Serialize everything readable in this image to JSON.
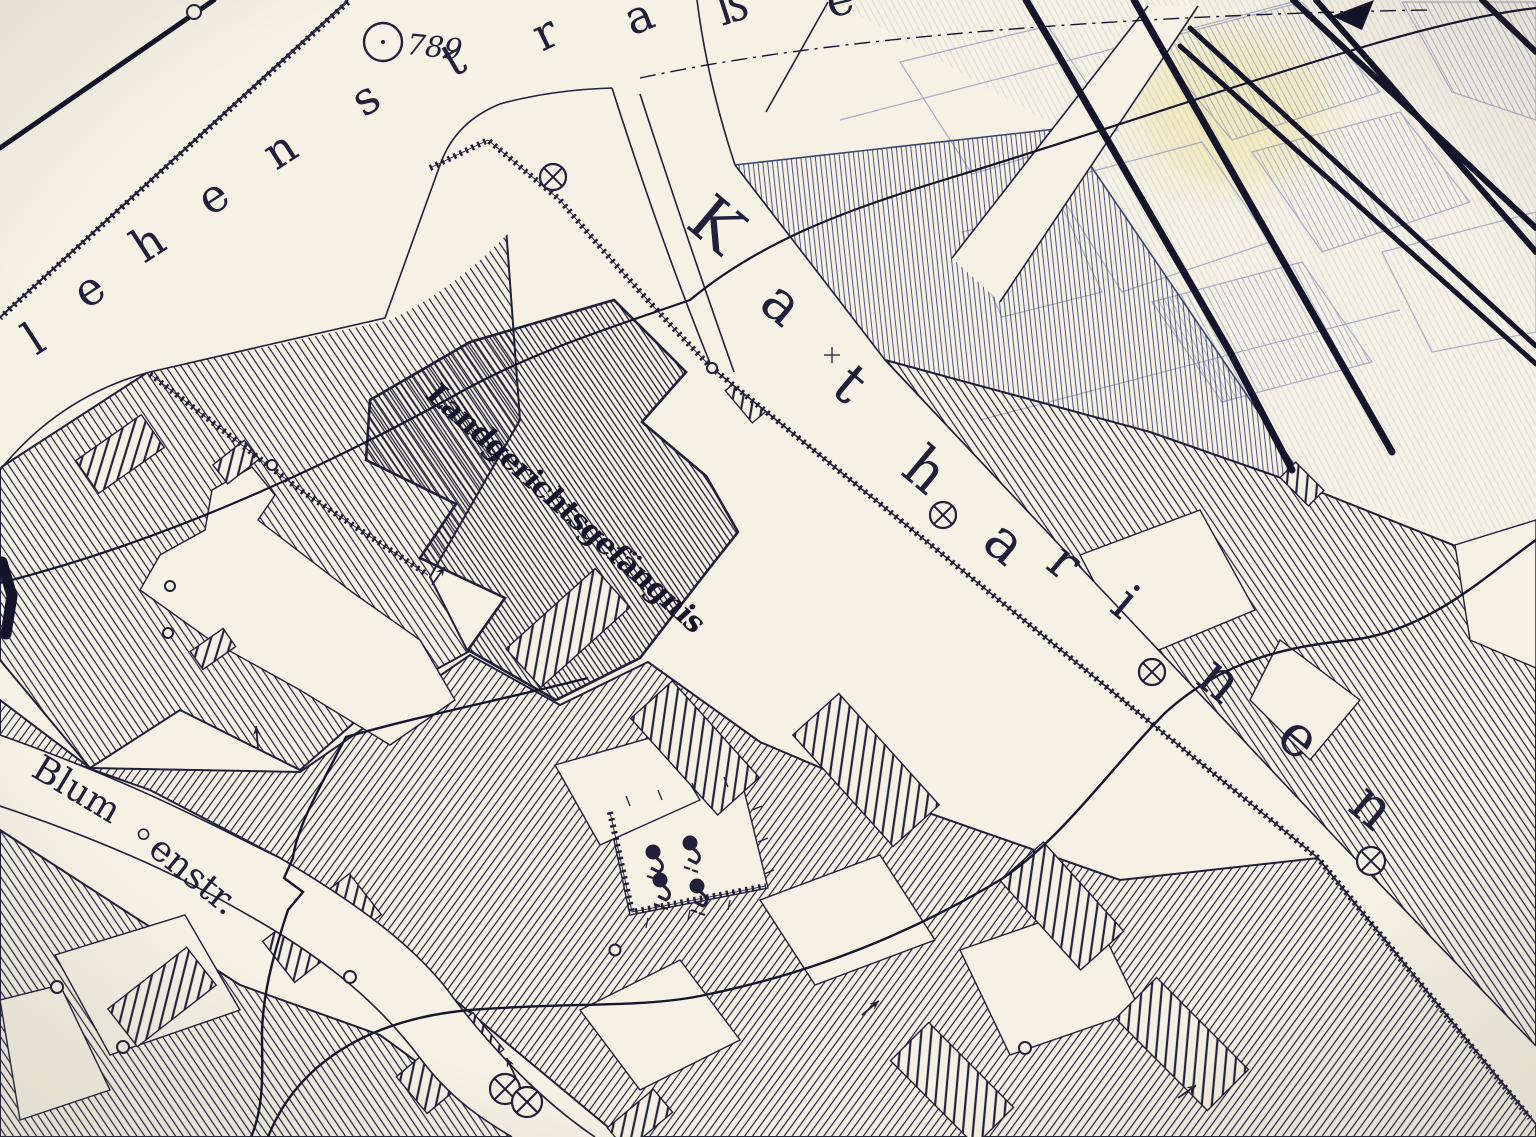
{
  "colors": {
    "paper": "#f5f1e4",
    "ink": "#20203a",
    "faded_ink": "#7d86ae",
    "medium_ink": "#4a537f",
    "stain": "#efe3a4"
  },
  "marker": {
    "label": "789"
  },
  "streets": [
    {
      "id": "lehenstrasse",
      "name_visible": "lehenstraße",
      "letters": [
        {
          "ch": "l",
          "x": 36,
          "y": 356,
          "rot": -33,
          "size": 46
        },
        {
          "ch": "e",
          "x": 86,
          "y": 310,
          "rot": -33,
          "size": 46
        },
        {
          "ch": "h",
          "x": 144,
          "y": 264,
          "rot": -33,
          "size": 46
        },
        {
          "ch": "e",
          "x": 210,
          "y": 217,
          "rot": -33,
          "size": 46
        },
        {
          "ch": "n",
          "x": 276,
          "y": 171,
          "rot": -33,
          "size": 46
        },
        {
          "ch": "s",
          "x": 364,
          "y": 118,
          "rot": -33,
          "size": 46
        },
        {
          "ch": "t",
          "x": 453,
          "y": 78,
          "rot": -30,
          "size": 46
        },
        {
          "ch": "r",
          "x": 542,
          "y": 52,
          "rot": -26,
          "size": 46
        },
        {
          "ch": "a",
          "x": 632,
          "y": 36,
          "rot": -22,
          "size": 46
        },
        {
          "ch": "ß",
          "x": 722,
          "y": 26,
          "rot": -18,
          "size": 46
        },
        {
          "ch": "e",
          "x": 830,
          "y": 18,
          "rot": -14,
          "size": 46
        }
      ]
    },
    {
      "id": "katharinenstrasse",
      "name_visible": "Katharinen",
      "letters": [
        {
          "ch": "K",
          "x": 684,
          "y": 226,
          "rot": 40,
          "size": 64
        },
        {
          "ch": "a",
          "x": 757,
          "y": 307,
          "rot": 40,
          "size": 57
        },
        {
          "ch": "t",
          "x": 829,
          "y": 391,
          "rot": 40,
          "size": 57
        },
        {
          "ch": "h",
          "x": 899,
          "y": 473,
          "rot": 40,
          "size": 57
        },
        {
          "ch": "a",
          "x": 980,
          "y": 546,
          "rot": 40,
          "size": 57
        },
        {
          "ch": "r",
          "x": 1044,
          "y": 567,
          "rot": 40,
          "size": 52
        },
        {
          "ch": "i",
          "x": 1108,
          "y": 610,
          "rot": 40,
          "size": 52
        },
        {
          "ch": "n",
          "x": 1194,
          "y": 682,
          "rot": 40,
          "size": 57
        },
        {
          "ch": "e",
          "x": 1274,
          "y": 741,
          "rot": 40,
          "size": 57
        },
        {
          "ch": "n",
          "x": 1346,
          "y": 809,
          "rot": 40,
          "size": 57
        }
      ]
    }
  ],
  "blumenstrasse": {
    "part1": "Blum",
    "part2": "enstr."
  },
  "building_label": {
    "text": "Landgerichtsgefängnis"
  },
  "symbols": {
    "circle_dot": {
      "x": 383,
      "y": 42,
      "r": 19
    },
    "crossed_circles": [
      {
        "x": 553,
        "y": 177,
        "r": 13
      },
      {
        "x": 943,
        "y": 515,
        "r": 13
      },
      {
        "x": 1152,
        "y": 672,
        "r": 13
      },
      {
        "x": 1371,
        "y": 861,
        "r": 14
      },
      {
        "x": 505,
        "y": 1089,
        "r": 15
      },
      {
        "x": 527,
        "y": 1102,
        "r": 15
      }
    ],
    "rings": [
      {
        "x": 194,
        "y": 12,
        "r": 7
      },
      {
        "x": 272,
        "y": 465,
        "r": 5
      },
      {
        "x": 170,
        "y": 586,
        "r": 5
      },
      {
        "x": 168,
        "y": 633,
        "r": 5
      },
      {
        "x": 712,
        "y": 368,
        "r": 5
      },
      {
        "x": 350,
        "y": 977,
        "r": 6
      },
      {
        "x": 123,
        "y": 1047,
        "r": 6
      },
      {
        "x": 57,
        "y": 987,
        "r": 6
      },
      {
        "x": 615,
        "y": 950,
        "r": 5.5
      },
      {
        "x": 1025,
        "y": 1048,
        "r": 6
      }
    ],
    "trees": [
      {
        "x": 653,
        "y": 852
      },
      {
        "x": 690,
        "y": 843
      },
      {
        "x": 660,
        "y": 880
      },
      {
        "x": 697,
        "y": 886
      }
    ],
    "survey_arrows": [
      {
        "x": 862,
        "y": 1015,
        "rot": -40
      },
      {
        "x": 516,
        "y": 1078,
        "rot": -115
      },
      {
        "x": 258,
        "y": 748,
        "rot": -95
      },
      {
        "x": 1178,
        "y": 1098,
        "rot": -35
      },
      {
        "x": 432,
        "y": 585,
        "rot": -55
      }
    ]
  }
}
